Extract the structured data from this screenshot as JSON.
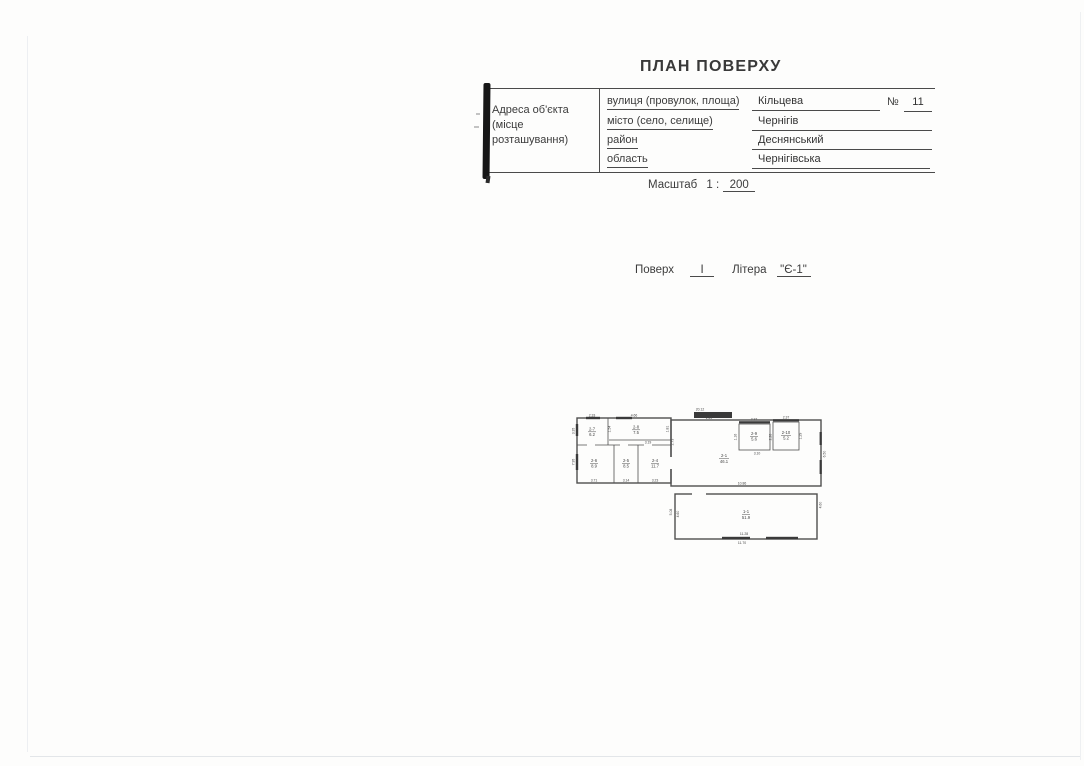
{
  "page": {
    "title": "ПЛАН ПОВЕРХУ"
  },
  "address_block": {
    "label_line1": "Адреса об'єкта",
    "label_line2": "(місце розташування)",
    "rows": [
      {
        "label": "вулиця (провулок, площа)",
        "value": "Кільцева"
      },
      {
        "label": "місто (село, селище)",
        "value": "Чернігів"
      },
      {
        "label": "район",
        "value": "Деснянський"
      },
      {
        "label": "область",
        "value": "Чернігівська"
      }
    ],
    "number_label": "№",
    "number_value": "11"
  },
  "scale": {
    "label": "Масштаб",
    "ratio_prefix": "1 :",
    "ratio_value": "200"
  },
  "floor_line": {
    "floor_label": "Поверх",
    "floor_value": "I",
    "letter_label": "Літера",
    "letter_value": "\"Є-1\""
  },
  "plan": {
    "rooms": [
      {
        "number": "2-7",
        "area": "6.2"
      },
      {
        "number": "2-8",
        "area": "7.5"
      },
      {
        "number": "2-6",
        "area": "8.9"
      },
      {
        "number": "2-5",
        "area": "8.5"
      },
      {
        "number": "2-4",
        "area": "11.7"
      },
      {
        "number": "2-1",
        "area": "46.1"
      },
      {
        "number": "2-9",
        "area": "5.6"
      },
      {
        "number": "2-10",
        "area": "5.2"
      },
      {
        "number": "1-1",
        "area": "51.9"
      }
    ],
    "dims": [
      "2.33",
      "3.35",
      "4.66",
      "1.54",
      "1.81",
      "3.19",
      "7.95",
      "3.71",
      "3.14",
      "3.23",
      "20.12",
      "2.49",
      "2.73",
      "2.37",
      "2.37",
      "1.16",
      "2.26",
      "1.29",
      "3.10",
      "6.50",
      "10.86",
      "5.08",
      "4.60",
      "4.60",
      "11.28",
      "11.70"
    ]
  }
}
